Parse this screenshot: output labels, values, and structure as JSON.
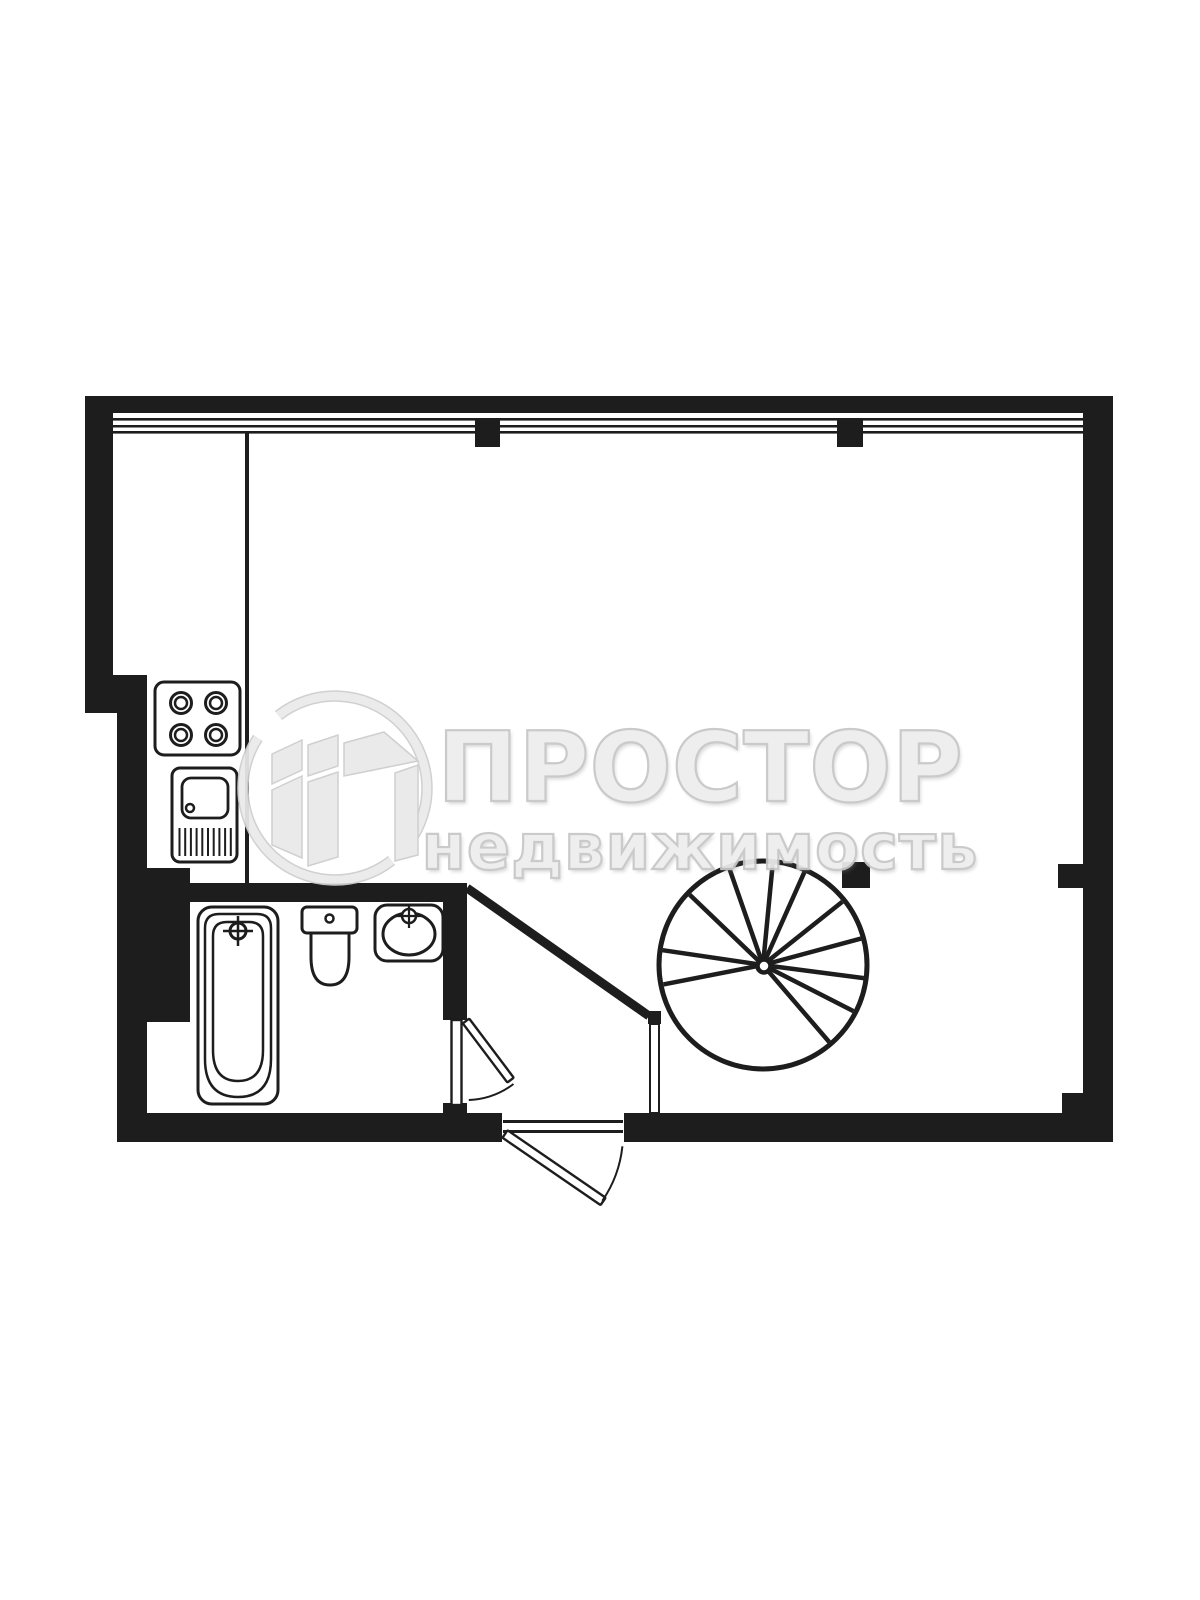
{
  "page": {
    "type": "apartment-floor-plan",
    "background": "#ffffff"
  },
  "colors": {
    "ink": "#1d1d1d",
    "watermark_fill": "#ededed",
    "watermark_outline": "#c7c7c7"
  },
  "watermark": {
    "brand": "ПРОСТОР",
    "tagline": "недвижимость"
  },
  "plan": {
    "fixtures": [
      "stove",
      "kitchen-sink",
      "bathtub",
      "toilet",
      "washbasin",
      "spiral-staircase"
    ],
    "doors": [
      "entry-door-swing-out",
      "bathroom-door-swing-out"
    ],
    "windows": [
      "full-width-glazing-top"
    ],
    "stairs": {
      "cx": 763,
      "cy": 965,
      "radius": 104,
      "hub_radius": 6.5,
      "tread_angles_deg": [
        169,
        188.4,
        223.8,
        250.8,
        275.5,
        294,
        321.4,
        344.9,
        7.4,
        27,
        49.3
      ]
    },
    "kitchen_sink": {
      "drain_line_count": 10
    }
  }
}
